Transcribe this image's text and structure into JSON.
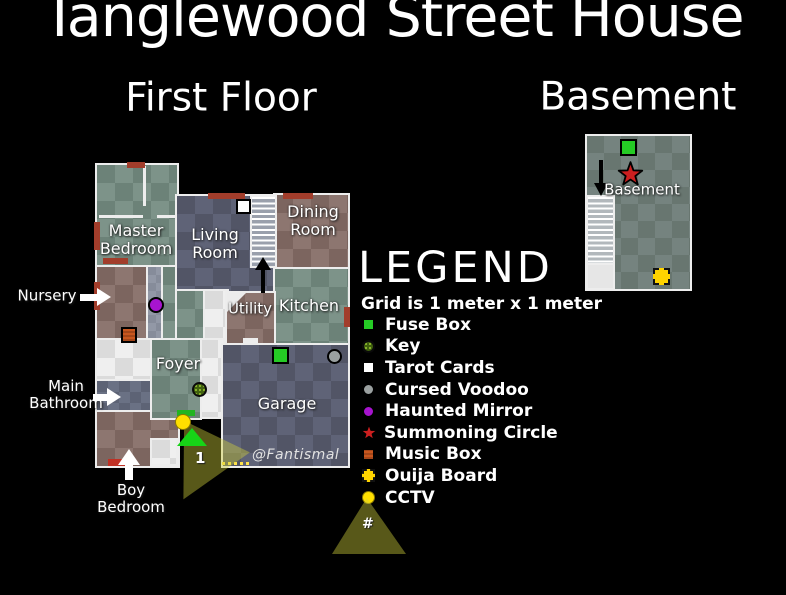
{
  "title": "Tanglewood Street House",
  "floor_titles": {
    "first_floor": "First Floor",
    "basement": "Basement"
  },
  "rooms": {
    "master_bedroom": "Master Bedroom",
    "living_room": "Living Room",
    "dining_room": "Dining Room",
    "kitchen": "Kitchen",
    "utility": "Utility",
    "foyer": "Foyer",
    "garage": "Garage",
    "basement": "Basement"
  },
  "annotations": {
    "nursery": "Nursery",
    "main_bathroom": "Main Bathroom",
    "boy_bedroom": "Boy Bedroom"
  },
  "watermark": "@Fantismal",
  "cctv": {
    "camera_1_label": "1",
    "legend_cone_symbol": "#",
    "cone_color": "#5c5c12"
  },
  "legend": {
    "title": "LEGEND",
    "grid_note": "Grid is 1 meter x 1 meter",
    "items": [
      {
        "label": "Fuse Box",
        "icon": "fuse-box-icon",
        "shape": "square",
        "color": "#25cb25"
      },
      {
        "label": "Key",
        "icon": "key-icon",
        "shape": "dotted-circle",
        "color": "#6f8f24"
      },
      {
        "label": "Tarot Cards",
        "icon": "tarot-cards-icon",
        "shape": "square",
        "color": "#ffffff"
      },
      {
        "label": "Cursed Voodoo",
        "icon": "cursed-voodoo-icon",
        "shape": "circle",
        "color": "#9aa0a0"
      },
      {
        "label": "Haunted Mirror",
        "icon": "haunted-mirror-icon",
        "shape": "circle",
        "color": "#a714cf"
      },
      {
        "label": "Summoning Circle",
        "icon": "summoning-circle-icon",
        "shape": "star",
        "color": "#cc1f1f"
      },
      {
        "label": "Music Box",
        "icon": "music-box-icon",
        "shape": "square",
        "color": "#c8561e"
      },
      {
        "label": "Ouija Board",
        "icon": "ouija-board-icon",
        "shape": "square",
        "color": "#ffd400"
      },
      {
        "label": "CCTV",
        "icon": "cctv-icon",
        "shape": "circle",
        "color": "#ffdf00"
      }
    ]
  },
  "palette": {
    "bedroom_green": "#7d9389",
    "slate_blue": "#5f6377",
    "wood_brown": "#8d7670",
    "hall_white": "#efefef",
    "basement_gray": "#75837f",
    "door_marker_red": "#a23d2b"
  }
}
